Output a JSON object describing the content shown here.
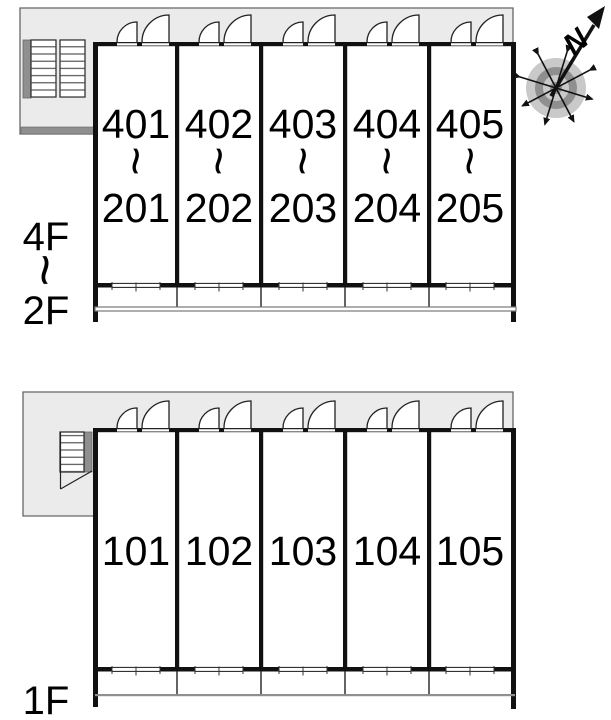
{
  "plan": {
    "upper_block": {
      "floor_label": {
        "top": "4F",
        "separator": "~",
        "bottom": "2F"
      },
      "units": [
        {
          "upper": "401",
          "separator": "~",
          "lower": "201"
        },
        {
          "upper": "402",
          "separator": "~",
          "lower": "202"
        },
        {
          "upper": "403",
          "separator": "~",
          "lower": "203"
        },
        {
          "upper": "404",
          "separator": "~",
          "lower": "204"
        },
        {
          "upper": "405",
          "separator": "~",
          "lower": "205"
        }
      ]
    },
    "lower_block": {
      "floor_label": {
        "top": "1F"
      },
      "units": [
        {
          "number": "101"
        },
        {
          "number": "102"
        },
        {
          "number": "103"
        },
        {
          "number": "104"
        },
        {
          "number": "105"
        }
      ]
    },
    "compass": {
      "north_label": "N"
    },
    "colors": {
      "corridor_fill": "#ebebeb",
      "outline": "#666666",
      "wall": "#111111",
      "stair_shadow": "#8f8f8f",
      "balcony_line": "#777777",
      "compass_ring_light": "#c9c9c9",
      "compass_ring_dark": "#8f8f8f"
    }
  }
}
